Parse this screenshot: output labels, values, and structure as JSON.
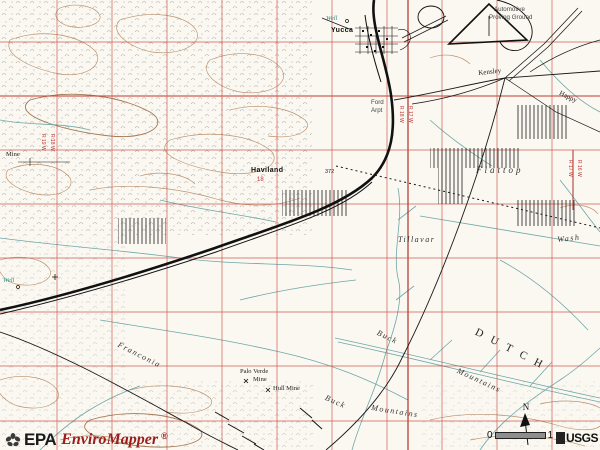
{
  "branding": {
    "epa_text": "EPA",
    "product_name": "EnviroMapper",
    "registered_mark": "®"
  },
  "map_controls": {
    "north_label": "N",
    "scale_zero": "0",
    "scale_one": "1",
    "usgs_label": "USGS"
  },
  "colors": {
    "grid_red": "#c4443a",
    "range_line_red": "#b03028",
    "contour_tan": "#b5855f",
    "wash_teal": "#5f9ea0",
    "brand_red": "#9b1c1c",
    "paper": "#faf8f1"
  },
  "map": {
    "labels": [
      {
        "name": "well-north",
        "text": "Well",
        "x": 326,
        "y": 16,
        "rot": 0,
        "cls": "t-well"
      },
      {
        "name": "yucca",
        "text": "Yucca",
        "x": 331,
        "y": 27,
        "rot": 0,
        "cls": "t-town"
      },
      {
        "name": "proving-ground-line1",
        "text": "Automotive",
        "x": 494,
        "y": 7,
        "rot": 0,
        "cls": "t-poi"
      },
      {
        "name": "proving-ground-line2",
        "text": "Proving Ground",
        "x": 489,
        "y": 15,
        "rot": 0,
        "cls": "t-poi"
      },
      {
        "name": "kensley",
        "text": "Kensley",
        "x": 478,
        "y": 70,
        "rot": -6,
        "cls": "t-site"
      },
      {
        "name": "happy",
        "text": "Happy",
        "x": 561,
        "y": 90,
        "rot": 26,
        "cls": "t-site"
      },
      {
        "name": "ford-arpt-line1",
        "text": "Ford",
        "x": 371,
        "y": 100,
        "rot": 0,
        "cls": "t-poi"
      },
      {
        "name": "ford-arpt-line2",
        "text": "Arpt",
        "x": 371,
        "y": 108,
        "rot": 0,
        "cls": "t-poi"
      },
      {
        "name": "range-r18w",
        "text": "R 18 W",
        "x": 398,
        "y": 106,
        "rot": 0,
        "cls": "t-range"
      },
      {
        "name": "range-r17w",
        "text": "R 17 W",
        "x": 407,
        "y": 106,
        "rot": 0,
        "cls": "t-range"
      },
      {
        "name": "flattop",
        "text": "Flattop",
        "x": 476,
        "y": 166,
        "rot": 0,
        "cls": "t-wash-lg"
      },
      {
        "name": "range-r17w-2",
        "text": "R 17 W",
        "x": 567,
        "y": 160,
        "rot": 0,
        "cls": "t-range"
      },
      {
        "name": "range-r16w-2",
        "text": "R 16 W",
        "x": 576,
        "y": 160,
        "rot": 0,
        "cls": "t-range"
      },
      {
        "name": "tillavar",
        "text": "Tillavar",
        "x": 398,
        "y": 236,
        "rot": 0,
        "cls": "t-wash"
      },
      {
        "name": "wash-flattop",
        "text": "Wash",
        "x": 557,
        "y": 236,
        "rot": -6,
        "cls": "t-wash"
      },
      {
        "name": "buck-upper",
        "text": "Buck",
        "x": 379,
        "y": 329,
        "rot": 26,
        "cls": "t-wash"
      },
      {
        "name": "mountains-upper",
        "text": "Mountains",
        "x": 459,
        "y": 367,
        "rot": 25,
        "cls": "t-wash"
      },
      {
        "name": "buck-lower",
        "text": "Buck",
        "x": 327,
        "y": 394,
        "rot": 24,
        "cls": "t-wash"
      },
      {
        "name": "mountains-lower",
        "text": "Mountains",
        "x": 372,
        "y": 404,
        "rot": 9,
        "cls": "t-wash"
      },
      {
        "name": "franconia",
        "text": "Franconia",
        "x": 120,
        "y": 341,
        "rot": 27,
        "cls": "t-wash"
      },
      {
        "name": "dutch-flat-region",
        "text": "DUTCH",
        "x": 478,
        "y": 327,
        "rot": 27,
        "cls": "t-region"
      },
      {
        "name": "well-west",
        "text": "Well",
        "x": 3,
        "y": 278,
        "rot": 0,
        "cls": "t-well"
      },
      {
        "name": "mine-west",
        "text": "Mine",
        "x": 6,
        "y": 152,
        "rot": 0,
        "cls": "t-mine"
      },
      {
        "name": "haviland",
        "text": "Haviland",
        "x": 251,
        "y": 167,
        "rot": 0,
        "cls": "t-town"
      },
      {
        "name": "section-18",
        "text": "18",
        "x": 257,
        "y": 177,
        "rot": 0,
        "cls": "t-sec"
      },
      {
        "name": "range-r19w",
        "text": "R 19 W",
        "x": 40,
        "y": 134,
        "rot": 0,
        "cls": "t-range"
      },
      {
        "name": "range-r18w-2",
        "text": "R 18 W",
        "x": 49,
        "y": 134,
        "rot": 0,
        "cls": "t-range"
      },
      {
        "name": "palo-verde-mine-line1",
        "text": "Palo Verde",
        "x": 240,
        "y": 369,
        "rot": 0,
        "cls": "t-mine"
      },
      {
        "name": "palo-verde-mine-line2",
        "text": "Mine",
        "x": 253,
        "y": 377,
        "rot": 0,
        "cls": "t-mine"
      },
      {
        "name": "hull-mine",
        "text": "Hull Mine",
        "x": 273,
        "y": 386,
        "rot": 0,
        "cls": "t-mine"
      },
      {
        "name": "benchmark-372",
        "text": "372",
        "x": 325,
        "y": 170,
        "rot": 0,
        "cls": "t-bm"
      }
    ]
  }
}
